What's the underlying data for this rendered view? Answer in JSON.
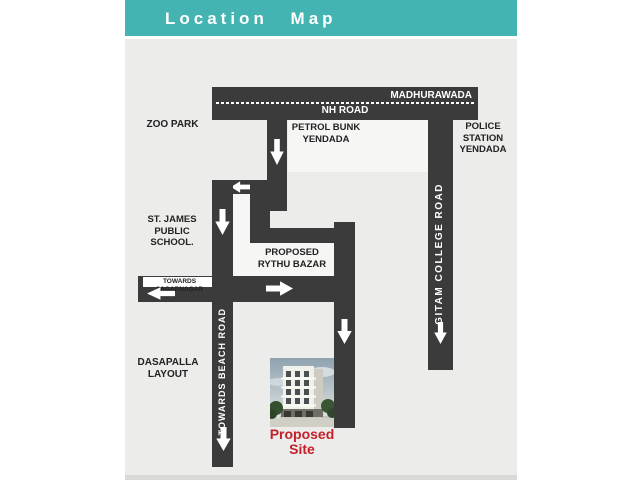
{
  "header": {
    "title": "Location Map"
  },
  "map": {
    "nh_road": {
      "name": "NH ROAD",
      "destination": "MADHURAWADA"
    },
    "gitam_road": "GITAM COLLEGE ROAD",
    "beach_road": "TOWARDS BEACH ROAD",
    "sagarnagar_road": "TOWARDS SAGARNAGAR",
    "landmarks": {
      "zoo_park": "ZOO PARK",
      "petrol_bunk_line1": "PETROL BUNK",
      "petrol_bunk_line2": "YENDADA",
      "police_line1": "POLICE",
      "police_line2": "STATION",
      "police_line3": "YENDADA",
      "st_james_line1": "ST. JAMES PUBLIC",
      "st_james_line2": "SCHOOL.",
      "rythu_line1": "PROPOSED",
      "rythu_line2": "RYTHU BAZAR",
      "dasapalla_line1": "DASAPALLA",
      "dasapalla_line2": "LAYOUT"
    },
    "site": {
      "line1": "Proposed",
      "line2": "Site"
    }
  },
  "colors": {
    "header_bg": "#43b4b1",
    "road": "#3b3b3b",
    "map_bg": "#ececeb",
    "site_text": "#c4202a"
  }
}
